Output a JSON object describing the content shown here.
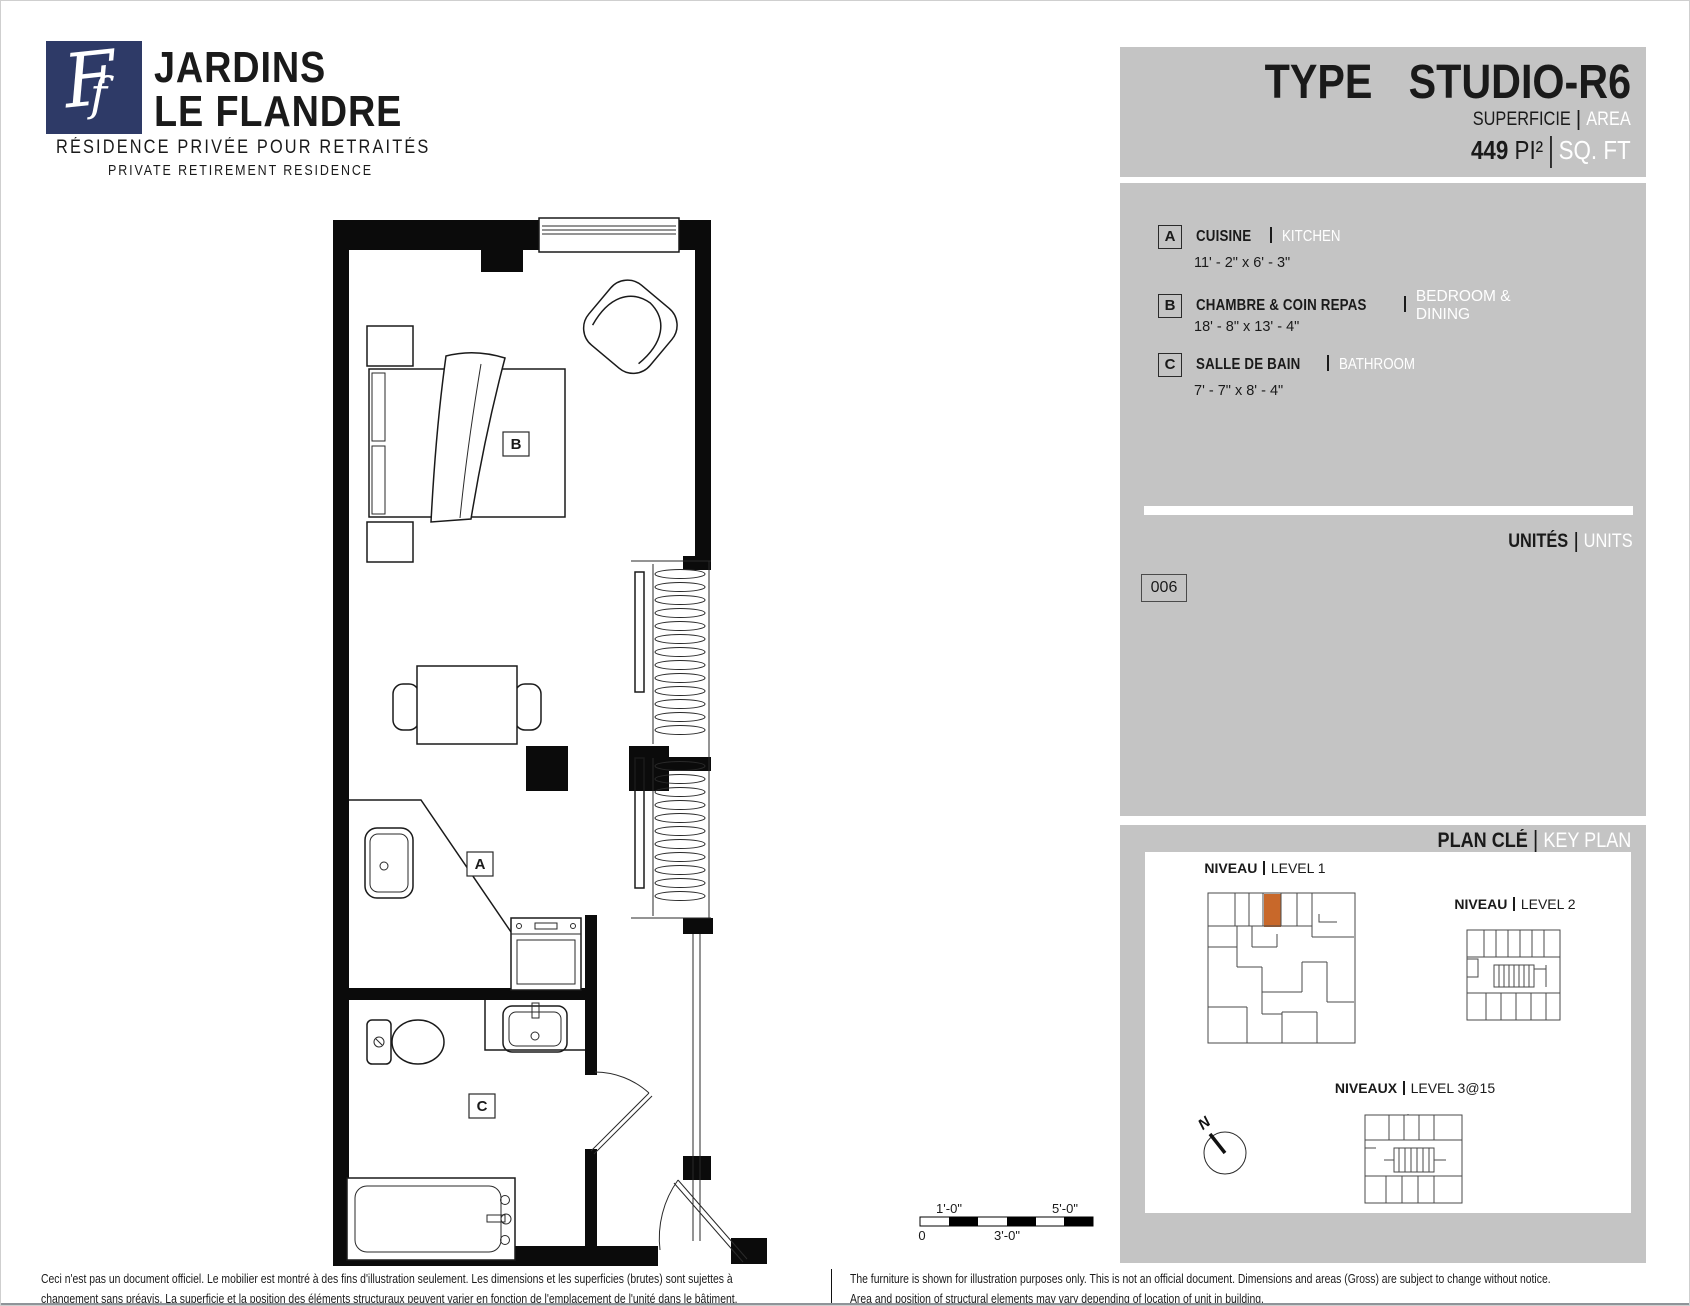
{
  "logo": {
    "monogram": "F",
    "name_line1": "JARDINS",
    "name_line2": "LE FLANDRE",
    "subtitle_fr": "RÉSIDENCE PRIVÉE POUR RETRAITÉS",
    "subtitle_en": "PRIVATE RETIREMENT RESIDENCE",
    "navy_color": "#2e3a67"
  },
  "title_panel": {
    "type_label": "TYPE",
    "type_value": "STUDIO-R6",
    "superficie_label": "SUPERFICIE",
    "area_label": "AREA",
    "area_value": "449",
    "area_unit_fr": "PI²",
    "area_unit_en": "SQ. FT"
  },
  "legend": {
    "items": [
      {
        "key": "A",
        "name_fr": "CUISINE",
        "name_en": "KITCHEN",
        "dims": "11' - 2\" x 6' - 3\""
      },
      {
        "key": "B",
        "name_fr": "CHAMBRE & COIN REPAS",
        "name_en": "BEDROOM & DINING",
        "dims": "18' - 8\" x 13' - 4\""
      },
      {
        "key": "C",
        "name_fr": "SALLE DE BAIN",
        "name_en": "BATHROOM",
        "dims": "7' - 7\" x 8' - 4\""
      }
    ]
  },
  "units_section": {
    "label_fr": "UNITÉS",
    "label_en": "UNITS",
    "unit_number": "006"
  },
  "key_plan": {
    "title_fr": "PLAN CLÉ",
    "title_en": "KEY PLAN",
    "levels": [
      {
        "prefix": "NIVEAU",
        "name": "LEVEL 1"
      },
      {
        "prefix": "NIVEAU",
        "name": "LEVEL 2"
      },
      {
        "prefix": "NIVEAUX",
        "name": "LEVEL 3@15"
      }
    ],
    "north_label": "N",
    "highlight_color": "#c8682a"
  },
  "floor_plan": {
    "labels": {
      "a": "A",
      "b": "B",
      "c": "C"
    }
  },
  "scale_bar": {
    "top_left": "1'-0\"",
    "top_right": "5'-0\"",
    "bottom_left": "0",
    "bottom_mid": "3'-0\""
  },
  "disclaimer": {
    "fr_line1": "Ceci n'est pas un document officiel.  Le mobilier est montré à des fins d'illustration seulement.  Les dimensions et les superficies (brutes) sont sujettes à",
    "fr_line2": "changement sans préavis. La superficie et la position des éléments structuraux peuvent varier en fonction de l'emplacement de l'unité dans le bâtiment.",
    "en_line1": "The furniture is shown for illustration purposes only.  This is not an official document.  Dimensions and areas (Gross) are subject to change without notice.",
    "en_line2": "Area and position of structural elements may vary depending of location of unit in building."
  }
}
